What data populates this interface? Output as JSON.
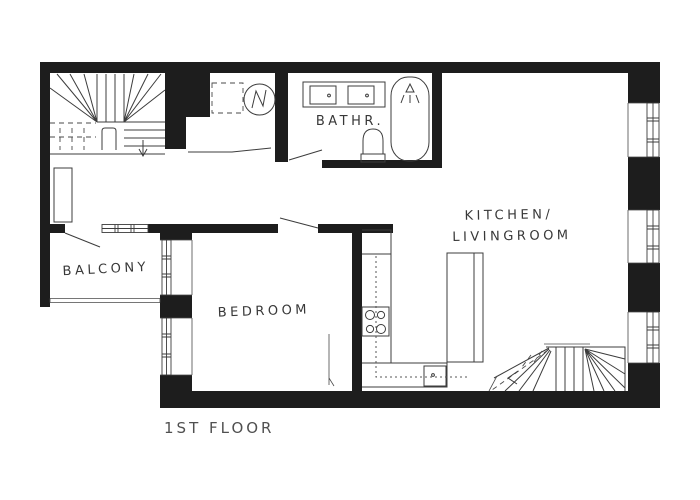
{
  "floor_label": "1ST FLOOR",
  "rooms": {
    "balcony": {
      "label": "BALCONY"
    },
    "bedroom": {
      "label": "BEDROOM"
    },
    "bathroom": {
      "label": "BATHR."
    },
    "kitchen_livingroom": {
      "label_line1": "KITCHEN/",
      "label_line2": "LIVINGROOM"
    }
  },
  "fixtures": {
    "upper_staircase": "winder staircase with down arrow",
    "lower_staircase": "winder staircase with dashed walk line and arrow",
    "utility_nook": [
      "dashed shower square",
      "washing machine"
    ],
    "bathroom": [
      "vanity with two sinks",
      "toilet",
      "bathtub with shower head"
    ],
    "kitchen": [
      "L-shaped counter",
      "4-burner stove",
      "sink",
      "island counter"
    ],
    "hallway": [
      "closet"
    ],
    "balcony": [
      "railing"
    ],
    "windows": [
      "3 right-wall windows",
      "2 bedroom left-wall windows",
      "balcony window"
    ]
  },
  "colors": {
    "background": "#ffffff",
    "wall": "#1d1d1d",
    "line": "#3c3c3c",
    "text": "#383838",
    "title": "#505050"
  }
}
